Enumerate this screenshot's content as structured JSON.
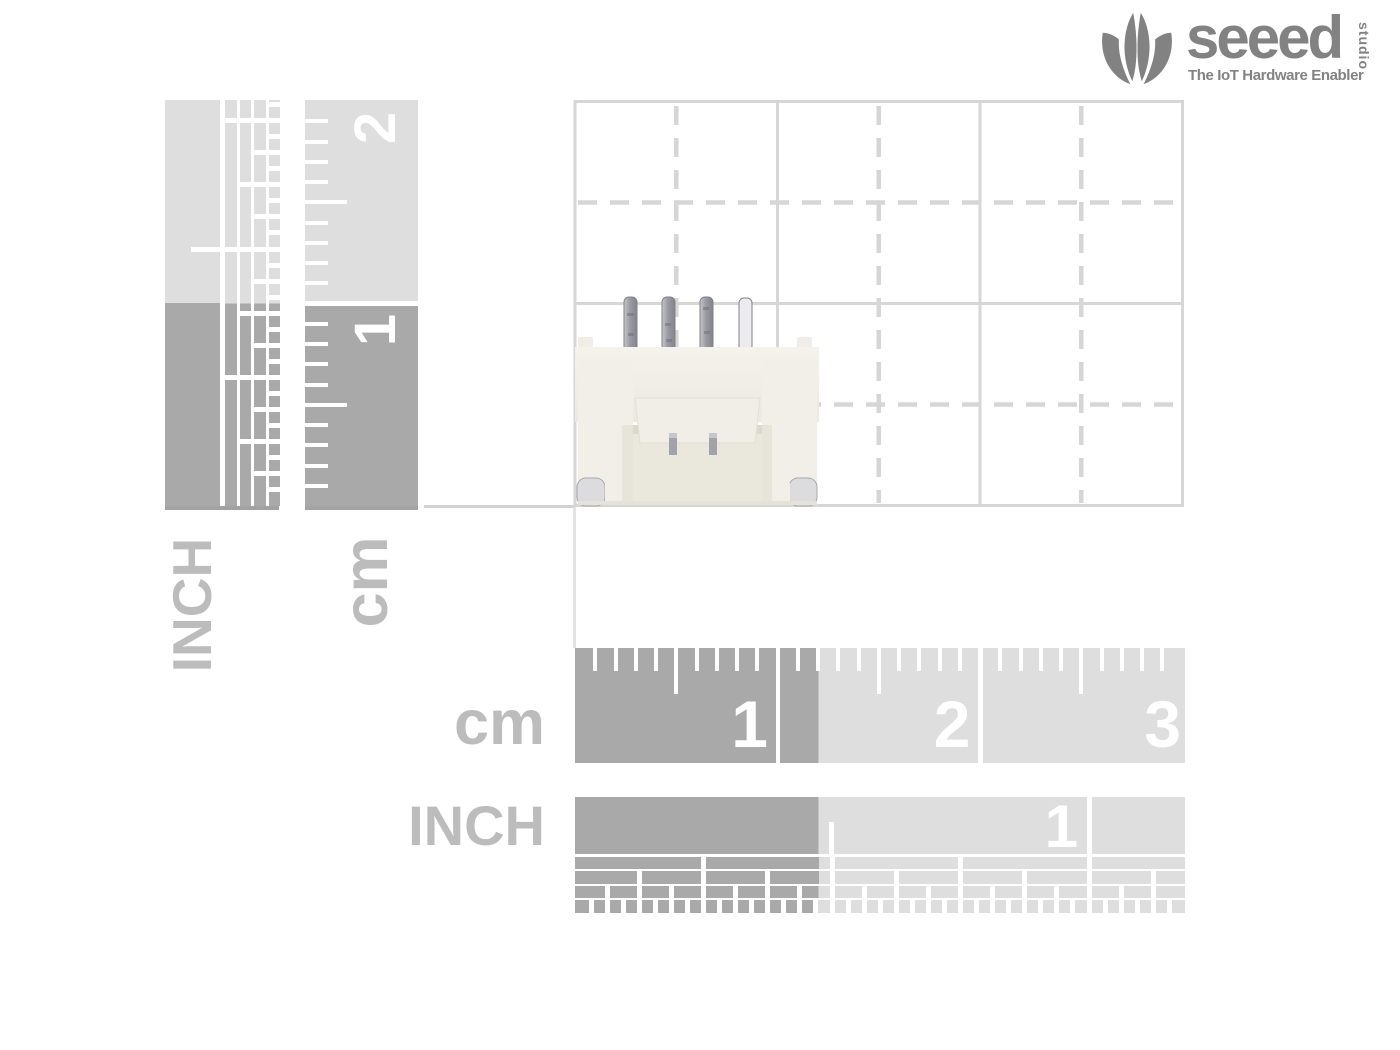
{
  "logo": {
    "brand": "seeed",
    "brand_sub": "studio",
    "tagline": "The IoT Hardware Enabler"
  },
  "rulers": {
    "left_inch_label": "INCH",
    "left_cm_label": "cm",
    "left_cm_numbers": [
      "2",
      "1"
    ],
    "bottom_cm_label": "cm",
    "bottom_cm_numbers": [
      "1",
      "2",
      "3"
    ],
    "bottom_inch_label": "INCH",
    "bottom_inch_numbers": [
      "1"
    ]
  },
  "photo": {
    "subject": "white 4-pin SMD connector"
  },
  "colors": {
    "ruler_light": "#dedede",
    "ruler_dark": "#a9a9a9",
    "label_gray": "#bcbcbc",
    "grid_line": "#d6d6d6",
    "logo_gray": "#828282",
    "number_white": "#ffffff"
  }
}
